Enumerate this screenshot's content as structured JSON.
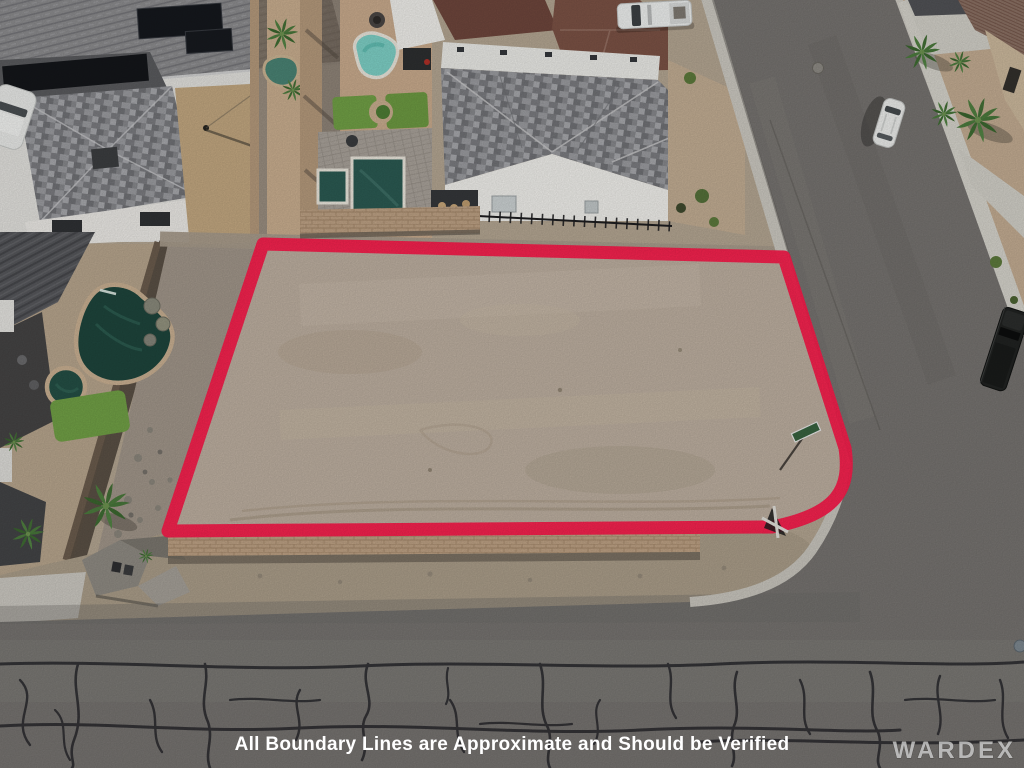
{
  "image": {
    "type": "aerial drone photograph",
    "subject": "vacant dirt residential lot outlined with painted red boundary lines",
    "setting": "desert residential neighborhood with homes, backyard swimming pools, palm trees and paved streets"
  },
  "overlay": {
    "disclaimer": "All Boundary Lines are Approximate and Should be Verified",
    "watermark": "WARDEX"
  },
  "annotation": {
    "boundary_color": "#f81e4c",
    "boundary_stroke_width": "13",
    "boundary_path": "M263,244 L784,257 L845,448 C851,489 838,514 772,527 L168,531 Z",
    "boundary_style": "thick painted outline following lot edges with rounded street corner"
  },
  "scene": {
    "lot_fill": "#bdafa0",
    "road_fill": "#767370",
    "pool_turquoise": "#7ed0c6",
    "pool_rect": "#2b5a52",
    "pool_lagoon": "#1e453c",
    "lawn_green": "#71a046",
    "brick_wall": "#bda184",
    "concrete": "#d2d0c8",
    "desert_gravel": "#c3ac92"
  }
}
